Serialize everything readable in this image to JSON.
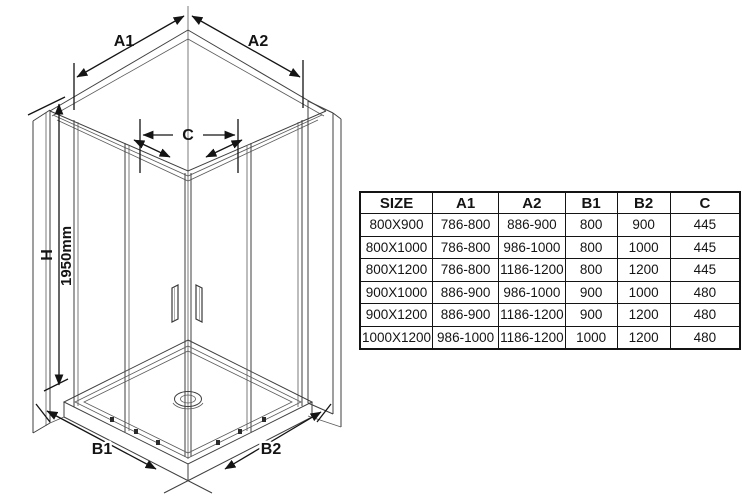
{
  "diagram": {
    "dim_labels": {
      "a1": "A1",
      "a2": "A2",
      "b1": "B1",
      "b2": "B2",
      "c": "C",
      "h": "H",
      "height": "1950mm"
    }
  },
  "table": {
    "headers": [
      "SIZE",
      "A1",
      "A2",
      "B1",
      "B2",
      "C"
    ],
    "rows": [
      [
        "800X900",
        "786-800",
        "886-900",
        "800",
        "900",
        "445"
      ],
      [
        "800X1000",
        "786-800",
        "986-1000",
        "800",
        "1000",
        "445"
      ],
      [
        "800X1200",
        "786-800",
        "1186-1200",
        "800",
        "1200",
        "445"
      ],
      [
        "900X1000",
        "886-900",
        "986-1000",
        "900",
        "1000",
        "480"
      ],
      [
        "900X1200",
        "886-900",
        "1186-1200",
        "900",
        "1200",
        "480"
      ],
      [
        "1000X1200",
        "986-1000",
        "1186-1200",
        "1000",
        "1200",
        "480"
      ]
    ]
  },
  "colors": {
    "structure_line": "#3f3f3f",
    "dimension_line": "#141414",
    "table_border": "#141414",
    "background": "#ffffff"
  }
}
